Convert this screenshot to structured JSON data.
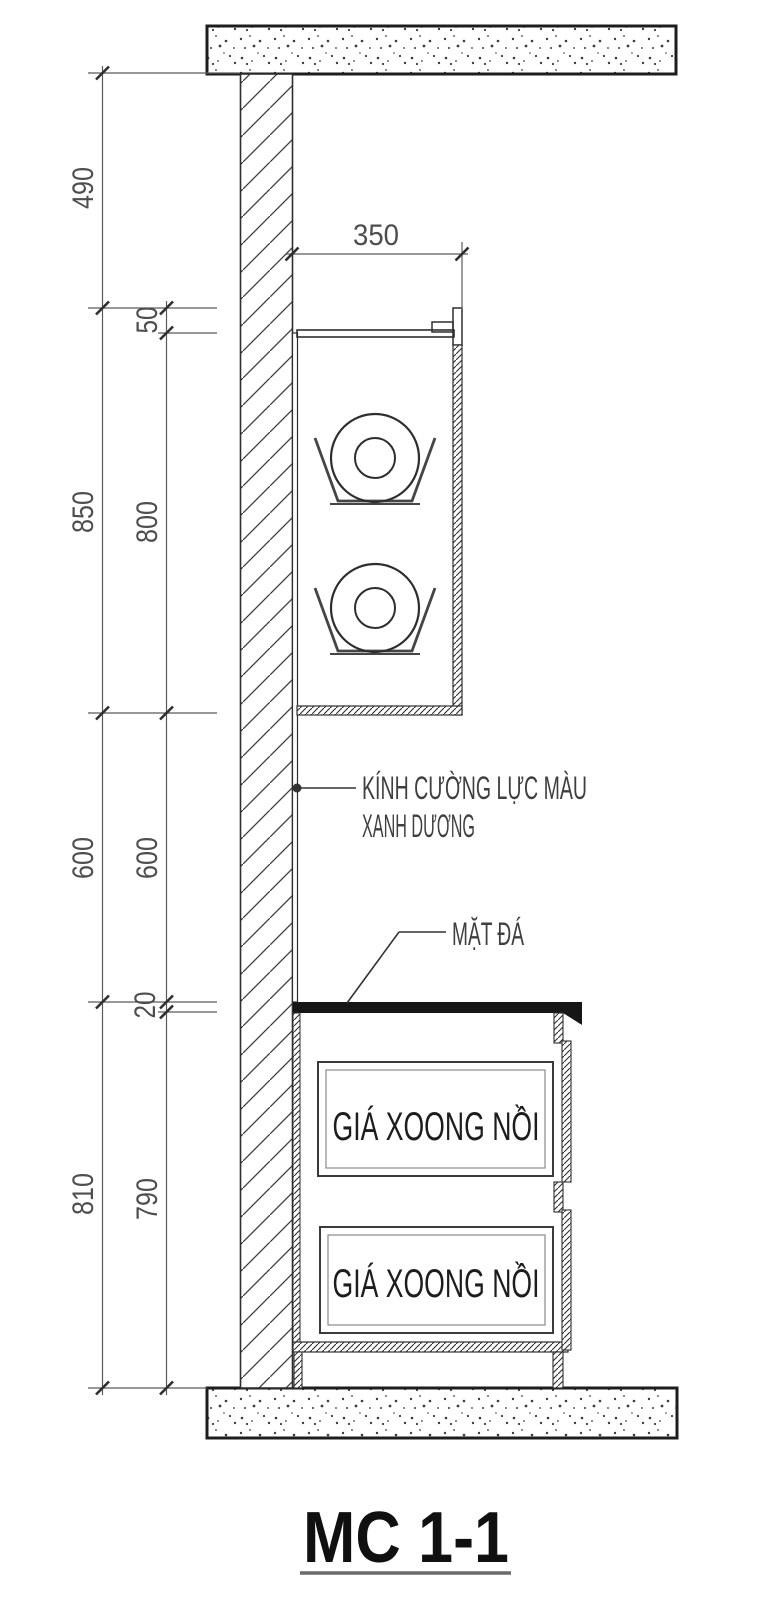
{
  "title": {
    "label": "MC 1-1"
  },
  "dimensions": {
    "left_outer": [
      "490",
      "850",
      "600",
      "810"
    ],
    "left_inner": [
      "50",
      "800",
      "600",
      "20",
      "790"
    ],
    "top_width": "350"
  },
  "notes": {
    "glass_line1": "KÍNH CƯỜNG LỰC MÀU",
    "glass_line2": "XANH DƯƠNG",
    "stone": "MẶT ĐÁ"
  },
  "drawers": [
    {
      "label": "GIÁ XOONG NỒI"
    },
    {
      "label": "GIÁ XOONG NỒI"
    }
  ],
  "colors": {
    "line": "#2e2e2e",
    "dimension_text": "#4e4e4e",
    "countertop_fill": "#161616",
    "background": "#ffffff"
  }
}
